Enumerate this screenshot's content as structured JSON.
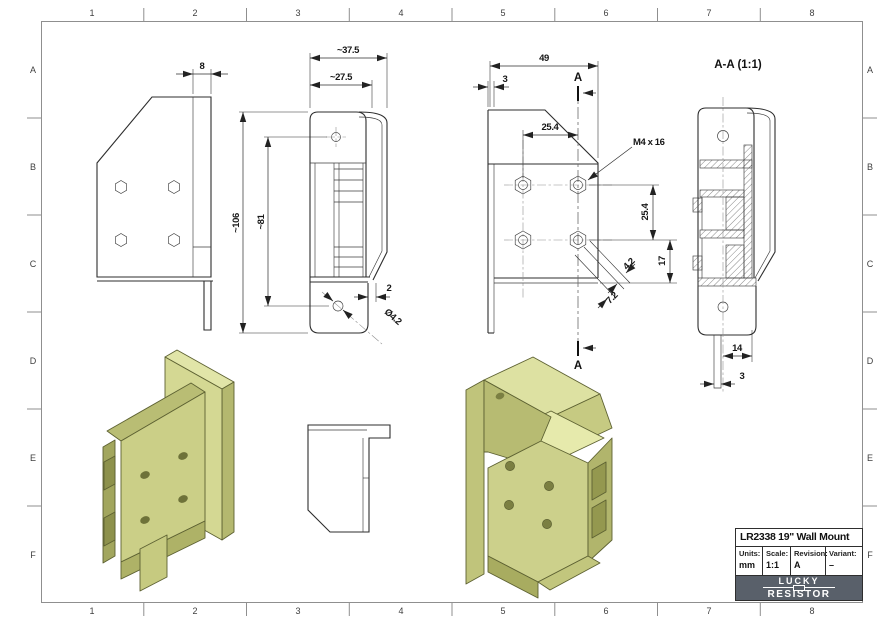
{
  "frame": {
    "cols": [
      "1",
      "2",
      "3",
      "4",
      "5",
      "6",
      "7",
      "8"
    ],
    "rows": [
      "A",
      "B",
      "C",
      "D",
      "E",
      "F"
    ]
  },
  "drawing": {
    "side": {
      "thickness": "8"
    },
    "front": {
      "overall_width": "~37.5",
      "hook_width": "~27.5",
      "overall_height": "~106",
      "hole_span": "~81",
      "gap": "2",
      "hole_dia": "Ø4.2"
    },
    "back": {
      "overall_width": "49",
      "wall": "3",
      "hole_offset": "25.4",
      "hole_pitch": "25.4",
      "bottom_offset": "17",
      "slot_width": "4.2",
      "slot_length": "7.2",
      "thread_callout": "M4 x 16",
      "section_letter": "A"
    },
    "section": {
      "title": "A-A (1:1)",
      "tab_width": "14",
      "tab_thickness": "3"
    }
  },
  "title_block": {
    "title": "LR2338 19\" Wall Mount",
    "fields": [
      {
        "label": "Units:",
        "value": "mm"
      },
      {
        "label": "Scale:",
        "value": "1:1"
      },
      {
        "label": "Revision:",
        "value": "A"
      },
      {
        "label": "Variant:",
        "value": "–"
      }
    ],
    "logo": {
      "line1": "LUCKY",
      "line2": "RESISTOR"
    }
  },
  "colors": {
    "part_olive": "#ccd08a",
    "logo_bg": "#59606a",
    "frame_line": "#8f8f8f"
  }
}
